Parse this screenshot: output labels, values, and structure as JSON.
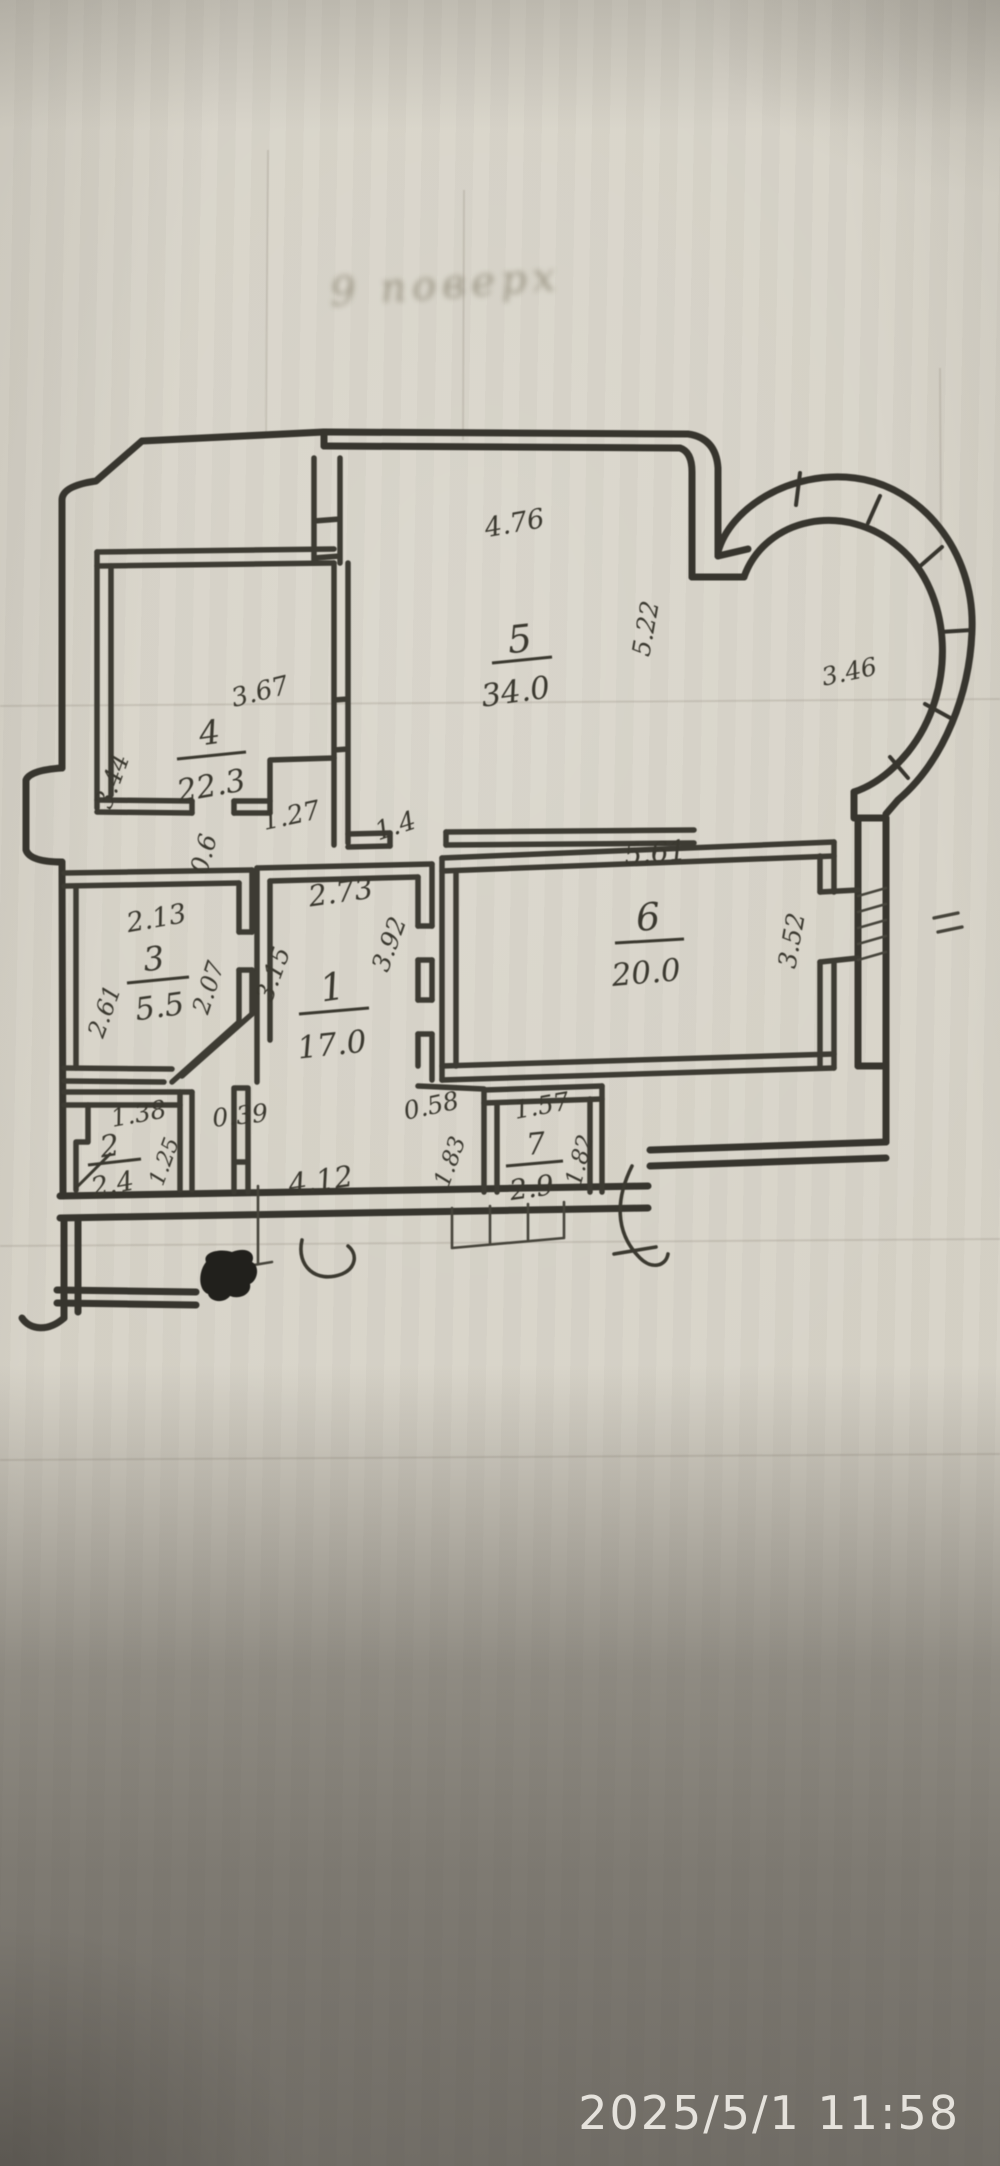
{
  "photo": {
    "timestamp": "2025/5/1 11:58",
    "paper_color": "#d7d3c8",
    "ink_color": "#3a382f",
    "timestamp_color": "#ece9e3"
  },
  "plan": {
    "floor_note": "9 поверх",
    "rooms": [
      {
        "number": "5",
        "area": "34.0",
        "nx": 521,
        "ny": 652,
        "nr": -6,
        "ns": 38,
        "ax": 517,
        "ay": 702,
        "ar": -8,
        "as": 31,
        "lx1": 492,
        "ly1": 663,
        "lx2": 552,
        "ly2": 657
      },
      {
        "number": "4",
        "area": "22.3",
        "nx": 211,
        "ny": 744,
        "nr": -8,
        "ns": 33,
        "ax": 213,
        "ay": 796,
        "ar": -10,
        "as": 31,
        "lx1": 177,
        "ly1": 759,
        "lx2": 246,
        "ly2": 752
      },
      {
        "number": "6",
        "area": "20.0",
        "nx": 649,
        "ny": 930,
        "nr": -4,
        "ns": 38,
        "ax": 647,
        "ay": 983,
        "ar": -5,
        "as": 31,
        "lx1": 615,
        "ly1": 943,
        "lx2": 684,
        "ly2": 939
      },
      {
        "number": "1",
        "area": "17.0",
        "nx": 334,
        "ny": 1000,
        "nr": -8,
        "ns": 38,
        "ax": 333,
        "ay": 1055,
        "ar": -6,
        "as": 31,
        "lx1": 299,
        "ly1": 1014,
        "lx2": 369,
        "ly2": 1008
      },
      {
        "number": "3",
        "area": "5.5",
        "nx": 155,
        "ny": 970,
        "nr": -6,
        "ns": 33,
        "ax": 161,
        "ay": 1017,
        "ar": -8,
        "as": 31,
        "lx1": 127,
        "ly1": 983,
        "lx2": 189,
        "ly2": 977
      },
      {
        "number": "2",
        "area": "2.4",
        "nx": 111,
        "ny": 1156,
        "nr": -8,
        "ns": 30,
        "ax": 114,
        "ay": 1193,
        "ar": -10,
        "as": 27,
        "lx1": 88,
        "ly1": 1165,
        "lx2": 141,
        "ly2": 1159
      },
      {
        "number": "7",
        "area": "2.9",
        "nx": 537,
        "ny": 1154,
        "nr": -6,
        "ns": 30,
        "ax": 533,
        "ay": 1197,
        "ar": -8,
        "as": 28,
        "lx1": 506,
        "ly1": 1166,
        "lx2": 563,
        "ly2": 1161
      }
    ],
    "dim_labels": [
      {
        "t": "4.76",
        "x": 516,
        "y": 532,
        "r": -10,
        "s": 27
      },
      {
        "t": "5.22",
        "x": 654,
        "y": 630,
        "r": -80,
        "s": 25
      },
      {
        "t": "3.46",
        "x": 851,
        "y": 680,
        "r": -12,
        "s": 25
      },
      {
        "t": "3.67",
        "x": 262,
        "y": 700,
        "r": -14,
        "s": 26
      },
      {
        "t": "3.44",
        "x": 120,
        "y": 784,
        "r": -70,
        "s": 25
      },
      {
        "t": "1.27",
        "x": 293,
        "y": 824,
        "r": -12,
        "s": 26
      },
      {
        "t": "0.6",
        "x": 212,
        "y": 856,
        "r": -75,
        "s": 25
      },
      {
        "t": "1.4",
        "x": 398,
        "y": 834,
        "r": -18,
        "s": 26
      },
      {
        "t": "5.61",
        "x": 656,
        "y": 862,
        "r": -5,
        "s": 28
      },
      {
        "t": "3.52",
        "x": 800,
        "y": 942,
        "r": -80,
        "s": 25
      },
      {
        "t": "2.73",
        "x": 342,
        "y": 902,
        "r": -8,
        "s": 29
      },
      {
        "t": "3.92",
        "x": 397,
        "y": 947,
        "r": -70,
        "s": 25
      },
      {
        "t": "3.15",
        "x": 281,
        "y": 977,
        "r": -70,
        "s": 25
      },
      {
        "t": "2.13",
        "x": 158,
        "y": 927,
        "r": -10,
        "s": 27
      },
      {
        "t": "2.61",
        "x": 112,
        "y": 1014,
        "r": -70,
        "s": 24
      },
      {
        "t": "2.07",
        "x": 216,
        "y": 990,
        "r": -72,
        "s": 24
      },
      {
        "t": "1.38",
        "x": 140,
        "y": 1122,
        "r": -10,
        "s": 25
      },
      {
        "t": "1.25",
        "x": 171,
        "y": 1164,
        "r": -70,
        "s": 22
      },
      {
        "t": "0.39",
        "x": 241,
        "y": 1124,
        "r": -6,
        "s": 25
      },
      {
        "t": "4.12",
        "x": 322,
        "y": 1190,
        "r": -8,
        "s": 29
      },
      {
        "t": "0.58",
        "x": 433,
        "y": 1114,
        "r": -12,
        "s": 25
      },
      {
        "t": "1.83",
        "x": 457,
        "y": 1164,
        "r": -70,
        "s": 23
      },
      {
        "t": "1.57",
        "x": 543,
        "y": 1114,
        "r": -10,
        "s": 25
      },
      {
        "t": "1.82",
        "x": 587,
        "y": 1162,
        "r": -75,
        "s": 23
      }
    ]
  }
}
